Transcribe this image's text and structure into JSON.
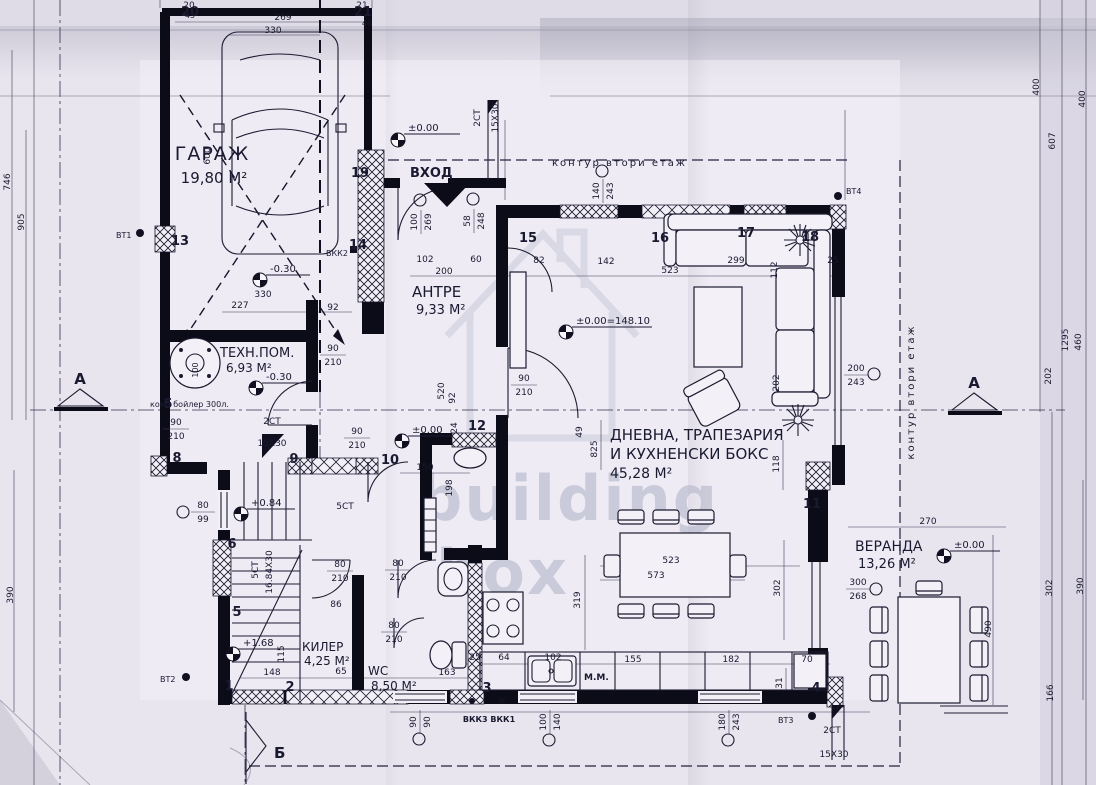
{
  "plan": {
    "rooms": {
      "garage_name": "ГАРАЖ",
      "garage_area": "19,80 М²",
      "antre_name": "АНТРЕ",
      "antre_area": "9,33 М²",
      "tech_name": "ТЕХН.ПОМ.",
      "tech_area": "6,93 М²",
      "tech_note": "комб бойлер 300л.",
      "living_name1": "ДНЕВНА, ТРАПЕЗАРИЯ",
      "living_name2": "И КУХНЕНСКИ БОКС",
      "living_area": "45,28 М²",
      "veranda_name": "ВЕРАНДА",
      "veranda_area": "13,26 М²",
      "kiler_name": "КИЛЕР",
      "kiler_area": "4,25 М²",
      "wc_name": "WC",
      "wc_area": "8,50 М²"
    },
    "labels": {
      "entrance": "ВХОД",
      "contour_top": "контур втори етаж",
      "contour_right": "контур втори етаж",
      "section_a": "А",
      "section_b": "Б",
      "s2": "2СТ",
      "s2_size": "15X30",
      "s5": "5СТ",
      "s5_size": "16.84X30",
      "washing_machine": "М.М.",
      "vt1": "ВТ1",
      "vt2": "ВТ2",
      "vt3": "ВТ3",
      "vt4": "ВТ4",
      "vkk2": "ВКК2",
      "vkk31": "ВКК3 ВКК1",
      "boiler_dia": "100"
    },
    "levels": {
      "entry": "±0.00",
      "hall": "±0.00",
      "living": "±0.00=148.10",
      "garage": "-0.30",
      "tech": "-0.30",
      "stair_mid": "+0.84",
      "stair_low": "+1.68",
      "veranda": "±0.00"
    },
    "nodes": {
      "n1": "1",
      "n2": "2",
      "n3": "3",
      "n4": "4",
      "n5": "5",
      "n5b": "5",
      "n6": "6",
      "n8": "8",
      "n9": "9",
      "n10": "10",
      "n11": "11",
      "n12": "12",
      "n13": "13",
      "n14": "14",
      "n15": "15",
      "n16": "16",
      "n17": "17",
      "n18": "18",
      "n19": "19",
      "n20": "20",
      "n21": "21"
    },
    "openings": {
      "aw_t": "100",
      "aw_b": "269",
      "ew_t": "58",
      "ew_b": "248",
      "lw_t": "140",
      "lw_b": "243",
      "rw_t": "200",
      "rw_b": "243",
      "vw_t": "300",
      "vw_b": "268",
      "sw_t": "80",
      "sw_b": "99",
      "kw_t": "90",
      "kw_b": "90",
      "kw2_t": "100",
      "kw2_b": "140",
      "tw_t": "180",
      "tw_b": "243",
      "dt_t": "90",
      "dt_b": "210",
      "dt2_t": "90",
      "dt2_b": "210",
      "dh_t": "90",
      "dh_b": "210",
      "dl_t": "90",
      "dl_b": "210",
      "dk_t": "80",
      "dk_b": "210",
      "dw_t": "80",
      "dw_b": "210",
      "dw2_t": "80",
      "dw2_b": "210"
    },
    "dims": {
      "t269": "269",
      "t330": "330",
      "t20": "20",
      "t45": "45",
      "t21": "21",
      "t46": "46",
      "l746": "746",
      "l905": "905",
      "l390": "390",
      "l600": "600",
      "g227": "227",
      "g92": "92",
      "g330": "330",
      "a102": "102",
      "a200": "200",
      "a60": "60",
      "a82": "82",
      "a142": "142",
      "a523": "523",
      "a299": "299",
      "a25": "25",
      "v825": "825",
      "v118": "118",
      "v49": "49",
      "v112": "112",
      "v202": "202",
      "m150": "150",
      "m198": "198",
      "m520": "520",
      "m92": "92",
      "m24": "24",
      "tb523": "523",
      "tb573": "573",
      "tb319": "319",
      "tb302": "302",
      "k155": "155",
      "k182": "182",
      "k70": "70",
      "k31": "31",
      "w163": "163",
      "w25": "25",
      "w64": "64",
      "w102": "102",
      "lo148": "148",
      "lo115": "115",
      "lo65": "65",
      "lo86": "86",
      "ve270": "270",
      "ve302": "302",
      "ve390": "390",
      "ve490": "490",
      "ve166": "166",
      "r607": "607",
      "r400a": "400",
      "r400b": "400",
      "r1295": "1295",
      "r460": "460",
      "r202": "202"
    },
    "watermark": {
      "line1": "building",
      "line2": "box"
    }
  }
}
